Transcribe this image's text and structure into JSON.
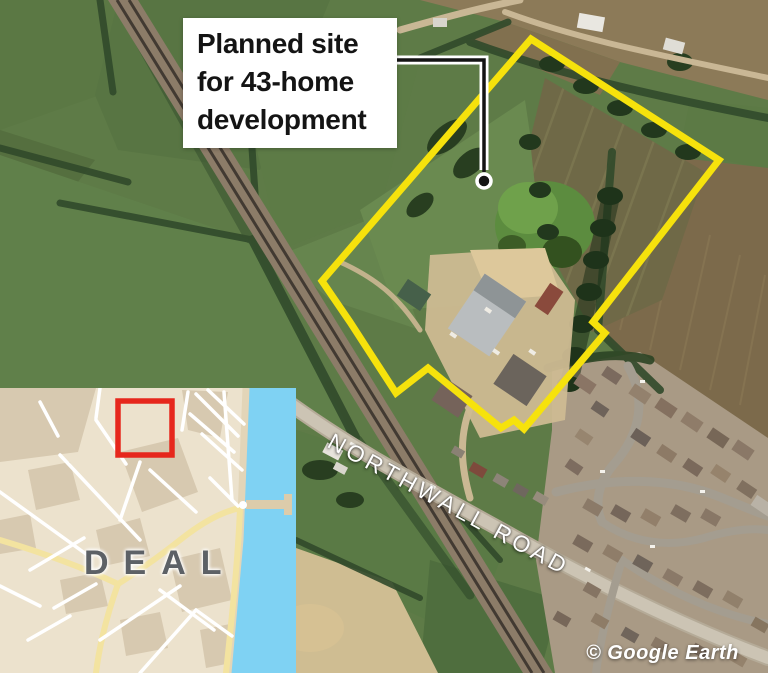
{
  "callout": {
    "lines": [
      "Planned site",
      "for 43-home",
      "development"
    ]
  },
  "road_label": "NORTHWALL ROAD",
  "inset": {
    "town_label": "DEAL"
  },
  "attribution": "© Google Earth",
  "colors": {
    "site_outline": "#f6e20c",
    "marker_red": "#e6271c",
    "callout_bg": "#ffffff",
    "callout_text": "#141414",
    "road_label_color": "#ffffff",
    "town_label_color": "#5d6166",
    "attribution_color": "#ffffff",
    "sea_color": "#7fd2f3"
  }
}
